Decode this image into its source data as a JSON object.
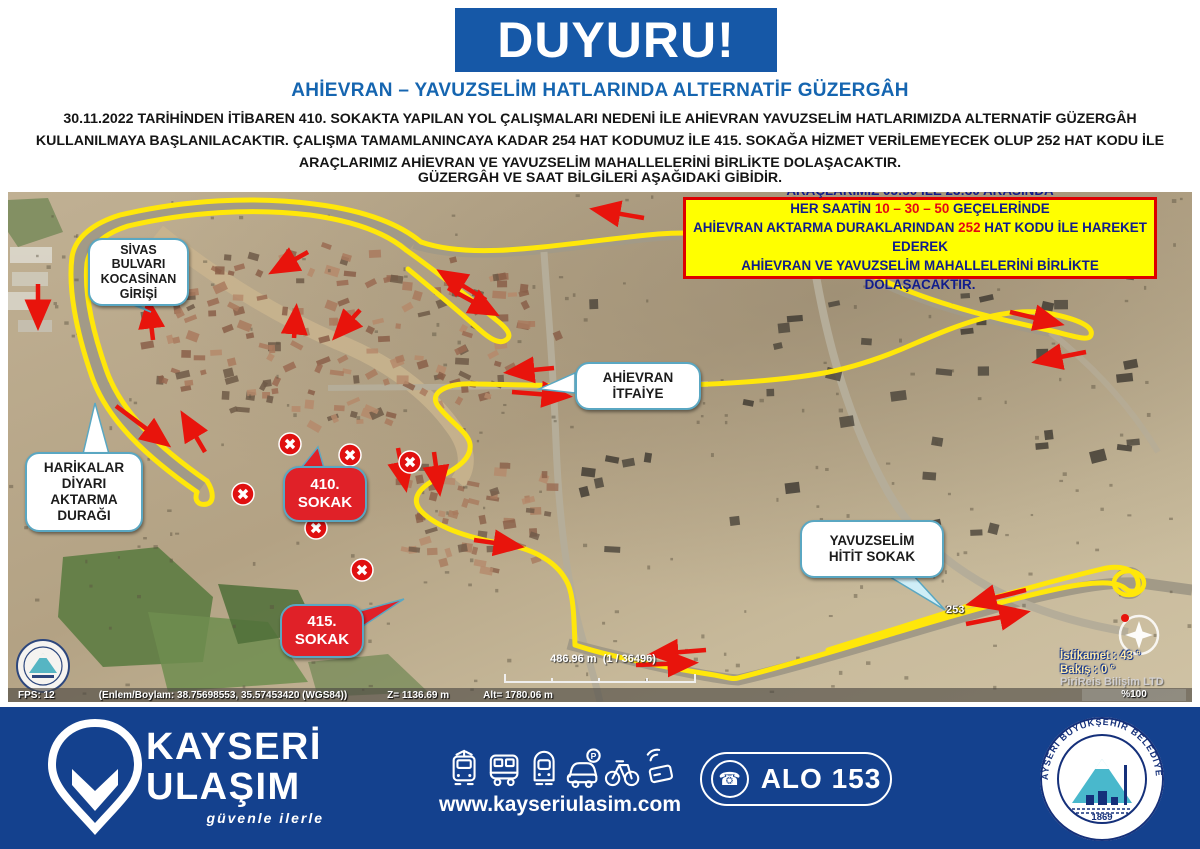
{
  "header": {
    "banner": "DUYURU!",
    "subtitle": "AHİEVRAN – YAVUZSELİM HATLARINDA ALTERNATİF GÜZERGÂH",
    "paragraph": "30.11.2022 TARİHİNDEN İTİBAREN 410. SOKAKTA YAPILAN YOL ÇALIŞMALARI NEDENİ İLE AHİEVRAN YAVUZSELİM HATLARIMIZDA ALTERNATİF GÜZERGÂH KULLANILMAYA BAŞLANILACAKTIR. ÇALIŞMA TAMAMLANINCAYA KADAR 254 HAT KODUMUZ İLE 415. SOKAĞA HİZMET VERİLEMEYECEK OLUP 252 HAT KODU İLE ARAÇLARIMIZ AHİEVRAN VE YAVUZSELİM MAHALLELERİNİ BİRLİKTE DOLAŞACAKTIR.",
    "footnote": "GÜZERGÂH VE SAAT BİLGİLERİ AŞAĞIDAKİ GİBİDİR."
  },
  "info_box": {
    "line1": "ARAÇLARIMIZ 05:50 İLE 23:30 ARASINDA",
    "line2_pre": "HER SAATİN ",
    "line2_red": "10 – 30 – 50",
    "line2_post": " GEÇELERİNDE",
    "line3_pre": "AHİEVRAN AKTARMA DURAKLARINDAN ",
    "line3_red": "252",
    "line3_post": " HAT KODU İLE HAREKET EDEREK",
    "line4": "AHİEVRAN VE YAVUZSELİM MAHALLELERİNİ BİRLİKTE DOLAŞACAKTIR."
  },
  "map": {
    "callouts": {
      "sivas": "SİVAS\nBULVARI\nKOCASİNAN\nGİRİŞİ",
      "harikalar": "HARİKALAR\nDİYARI\nAKTARMA\nDURAĞI",
      "itfaiye": "AHİEVRAN\nİTFAİYE",
      "yavuzselim": "YAVUZSELİM\nHİTİT SOKAK",
      "sokak410": "410.\nSOKAK",
      "sokak415": "415.\nSOKAK"
    },
    "road_label": "253",
    "status_bar": {
      "fps": "FPS: 12",
      "coords": "(Enlem/Boylam: 38.75698553, 35.57453420 (WGS84))",
      "z": "Z= 1136.69 m",
      "alt": "Alt= 1780.06 m"
    },
    "scale": {
      "distance": "486.96 m",
      "ratio": "(1 / 36496)"
    },
    "compass": {
      "heading": "İstikamet : 43 °",
      "view": "Bakış : 0 °"
    },
    "watermark": "PiriReis Bilişim LTD",
    "zoom_percent": "%100",
    "route_color": "#ffe70a",
    "arrow_color": "#e8140c"
  },
  "footer": {
    "brand_line1": "KAYSERİ",
    "brand_line2": "ULAŞIM",
    "brand_tagline": "güvenle ilerle",
    "website": "www.kayseriulasim.com",
    "phone_icon_glyph": "☎",
    "phone_label": "ALO 153",
    "seal_text": "KAYSERİ BÜYÜKŞEHİR BELEDİYESİ",
    "seal_year": "1869",
    "icons": [
      "tram-icon",
      "bus-icon",
      "metro-icon",
      "car-parking-icon",
      "bicycle-icon",
      "contactless-card-icon"
    ]
  },
  "colors": {
    "banner_blue": "#1658a7",
    "subtitle_blue": "#1565b0",
    "footer_navy": "#14418e",
    "info_yellow": "#ffff00",
    "alert_red": "#e01010",
    "route_yellow": "#ffe70a",
    "bubble_teal": "#5aa7c2",
    "seal_teal": "#49b8cc"
  }
}
